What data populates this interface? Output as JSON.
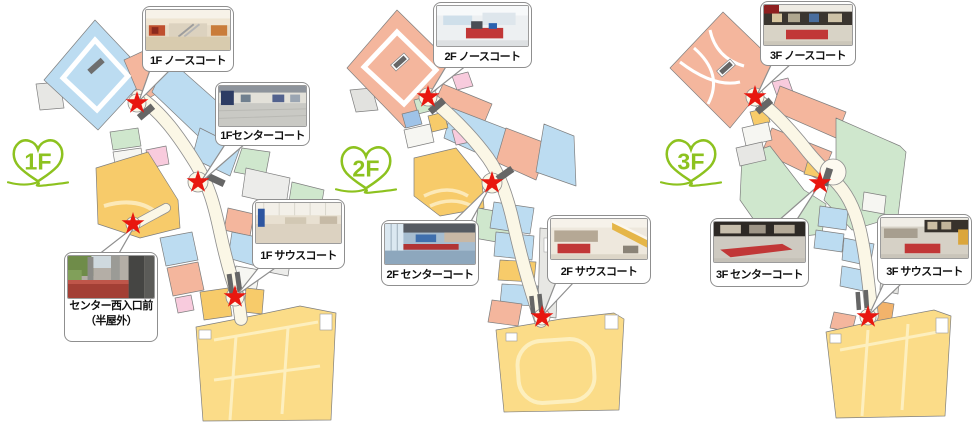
{
  "colors": {
    "star_red": "#e8170f",
    "heart_green": "#8dc21f",
    "map_blue": "#bcdcf1",
    "map_salmon": "#f4b69d",
    "map_yellow_anchor": "#fbdc88",
    "map_orange": "#f7cb6a",
    "map_green": "#cfe7cd",
    "map_pink": "#f8cbdd",
    "corridor_cream": "#fbf7e6"
  },
  "floors": [
    {
      "badge": "1F",
      "callouts": [
        {
          "label": "1F ノースコート"
        },
        {
          "label": "1Fセンターコート"
        },
        {
          "label": "1F サウスコート"
        },
        {
          "label": "センター西入口前",
          "label2": "（半屋外）"
        }
      ]
    },
    {
      "badge": "2F",
      "callouts": [
        {
          "label": "2F ノースコート"
        },
        {
          "label": "2F センターコート"
        },
        {
          "label": "2F サウスコート"
        }
      ]
    },
    {
      "badge": "3F",
      "callouts": [
        {
          "label": "3F ノースコート"
        },
        {
          "label": "3F センターコート"
        },
        {
          "label": "3F サウスコート"
        }
      ]
    }
  ]
}
